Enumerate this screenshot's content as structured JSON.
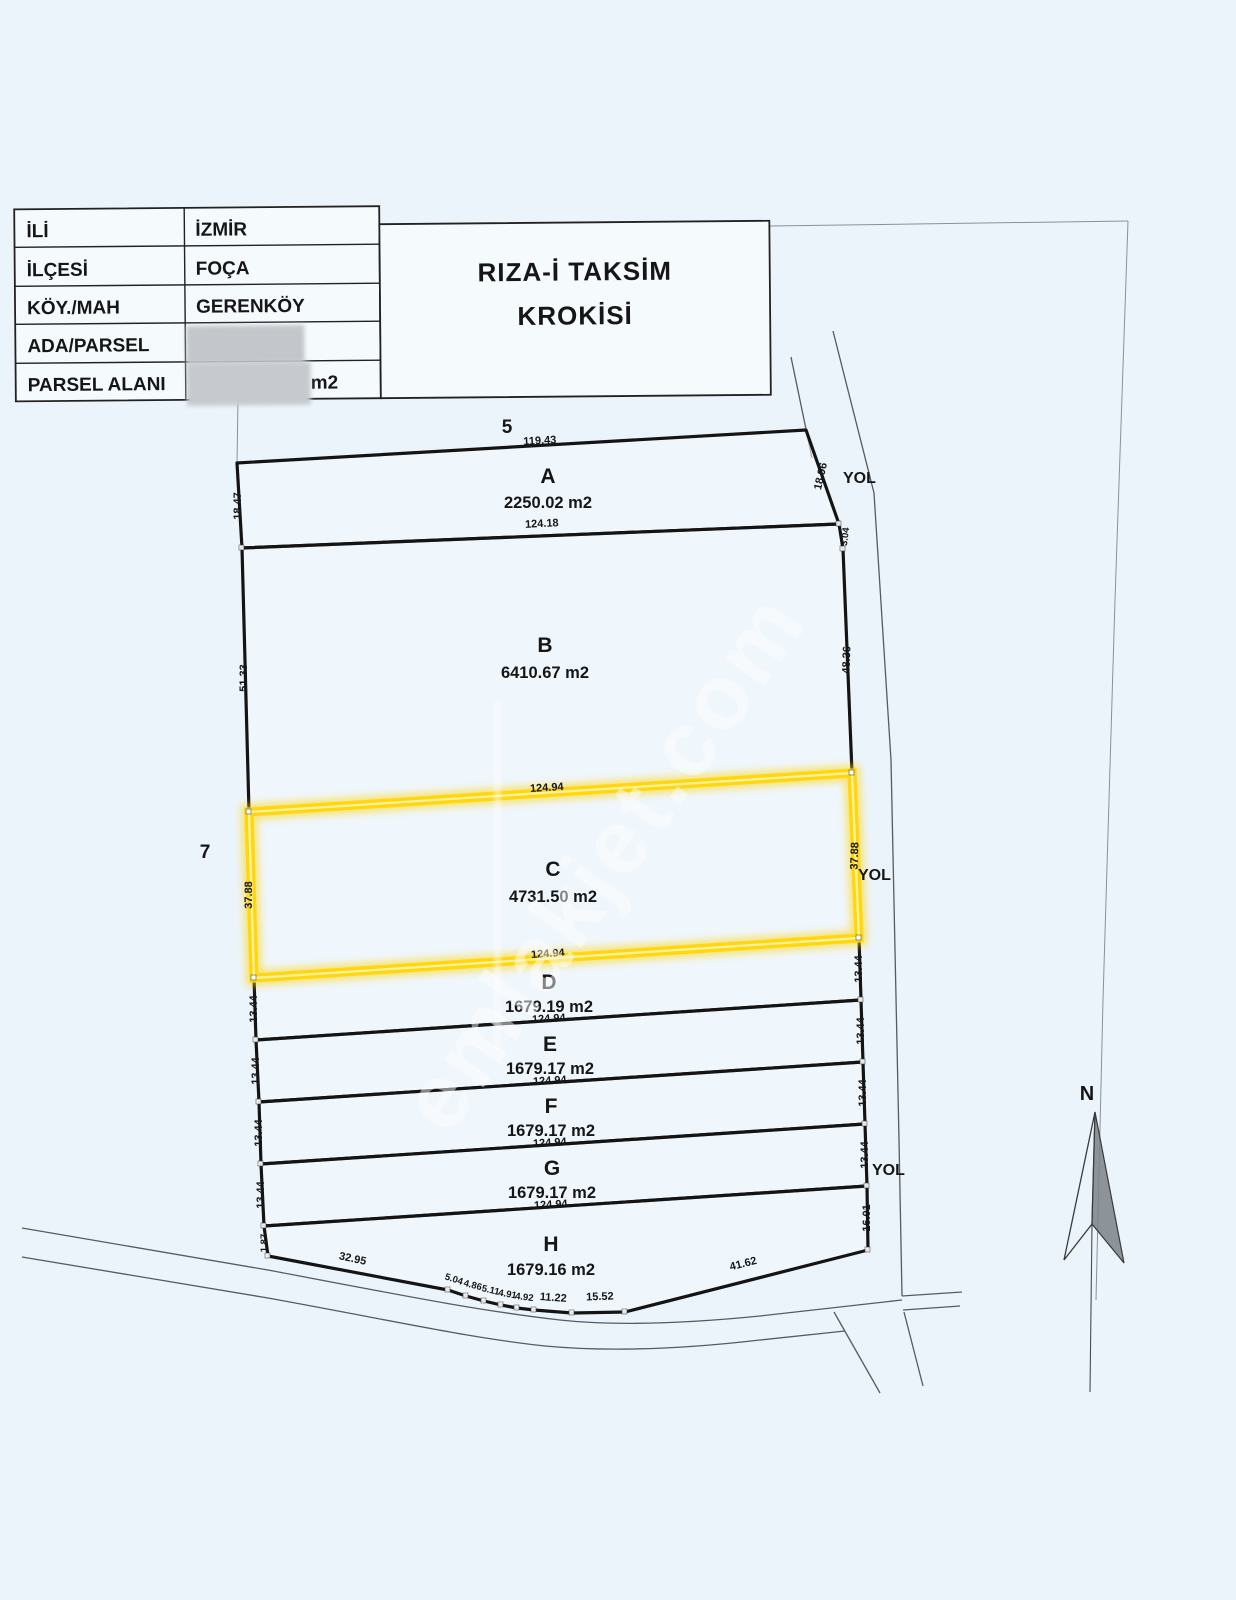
{
  "header": {
    "table": {
      "rows": [
        {
          "label": "İLİ",
          "value": "İZMİR"
        },
        {
          "label": "İLÇESİ",
          "value": "FOÇA"
        },
        {
          "label": "KÖY./MAH",
          "value": "GERENKÖY"
        },
        {
          "label": "ADA/PARSEL",
          "value": ""
        },
        {
          "label": "PARSEL ALANI",
          "value": "",
          "unit": "m2"
        }
      ]
    },
    "title": {
      "line1": "RIZA-İ TAKSİM",
      "line2": "KROKİSİ"
    }
  },
  "sketch": {
    "neighbor_top": "5",
    "neighbor_left": "7",
    "road_label": "YOL",
    "north_label": "N",
    "parcels": {
      "A": {
        "name": "A",
        "area": "2250.02 m2"
      },
      "B": {
        "name": "B",
        "area": "6410.67 m2"
      },
      "C": {
        "name": "C",
        "area": "4731.50 m2"
      },
      "D": {
        "name": "D",
        "area": "1679.19 m2"
      },
      "E": {
        "name": "E",
        "area": "1679.17 m2"
      },
      "F": {
        "name": "F",
        "area": "1679.17 m2"
      },
      "G": {
        "name": "G",
        "area": "1679.17 m2"
      },
      "H": {
        "name": "H",
        "area": "1679.16 m2"
      }
    },
    "dims": {
      "a_top": "119.43",
      "a_bottom": "124.18",
      "a_left": "18.47",
      "a_right": "18.96",
      "a_right_tick": "3.04",
      "b_left": "51.33",
      "b_right": "48.36",
      "c_top": "124.94",
      "c_bottom": "124.94",
      "c_left": "37.88",
      "c_right": "37.88",
      "d_left": "13.44",
      "d_right": "13.44",
      "d_bottom": "124.94",
      "e_left": "13.44",
      "e_right": "13.44",
      "e_bottom": "124.94",
      "f_left": "13.44",
      "f_right": "13.44",
      "f_bottom": "124.94",
      "g_left": "13.44",
      "g_right": "13.44",
      "g_bottom": "124.94",
      "h_left": "1.87",
      "h_right": "16.01",
      "bottom": [
        "32.95",
        "5.04",
        "4.86",
        "5.11",
        "4.91",
        "4.92",
        "11.22",
        "15.52",
        "41.62"
      ]
    },
    "highlight_color": "#FFD60A"
  },
  "watermark": "emlakjet.com"
}
